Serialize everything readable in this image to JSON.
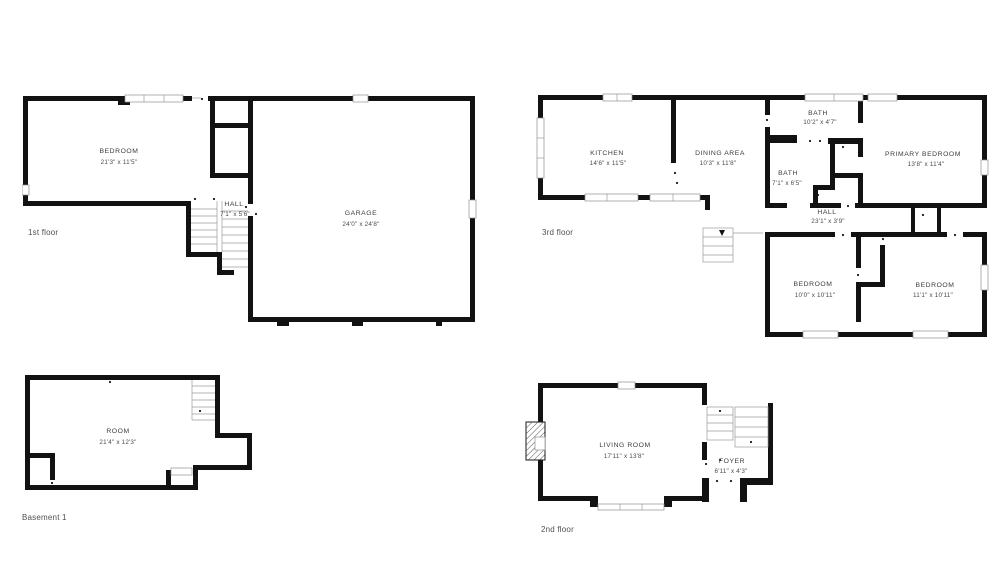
{
  "colors": {
    "wall": "#121212",
    "thin_line": "#9b9b9b",
    "room_text": "#3c3c3c",
    "floor_label_text": "#4f4f4f",
    "background": "#ffffff"
  },
  "floors": [
    {
      "id": "first-floor",
      "label": "1st floor",
      "rooms": [
        {
          "name": "BEDROOM",
          "dims": "21'3\" x 11'5\""
        },
        {
          "name": "HALL",
          "dims": "7'1\" x 5'6\""
        },
        {
          "name": "GARAGE",
          "dims": "24'0\" x 24'8\""
        }
      ]
    },
    {
      "id": "third-floor",
      "label": "3rd floor",
      "rooms": [
        {
          "name": "KITCHEN",
          "dims": "14'6\" x 11'5\""
        },
        {
          "name": "DINING AREA",
          "dims": "10'3\" x 11'8\""
        },
        {
          "name": "BATH",
          "dims": "10'2\" x 4'7\""
        },
        {
          "name": "BATH",
          "dims": "7'1\" x 6'5\""
        },
        {
          "name": "PRIMARY BEDROOM",
          "dims": "13'8\" x 11'4\""
        },
        {
          "name": "HALL",
          "dims": "23'1\" x 3'9\""
        },
        {
          "name": "BEDROOM",
          "dims": "10'0\" x 10'11\""
        },
        {
          "name": "BEDROOM",
          "dims": "11'1\" x 10'11\""
        }
      ]
    },
    {
      "id": "basement-1",
      "label": "Basement 1",
      "rooms": [
        {
          "name": "ROOM",
          "dims": "21'4\" x 12'3\""
        }
      ]
    },
    {
      "id": "second-floor",
      "label": "2nd floor",
      "rooms": [
        {
          "name": "LIVING ROOM",
          "dims": "17'11\" x 13'8\""
        },
        {
          "name": "FOYER",
          "dims": "6'11\" x 4'3\""
        }
      ]
    }
  ]
}
